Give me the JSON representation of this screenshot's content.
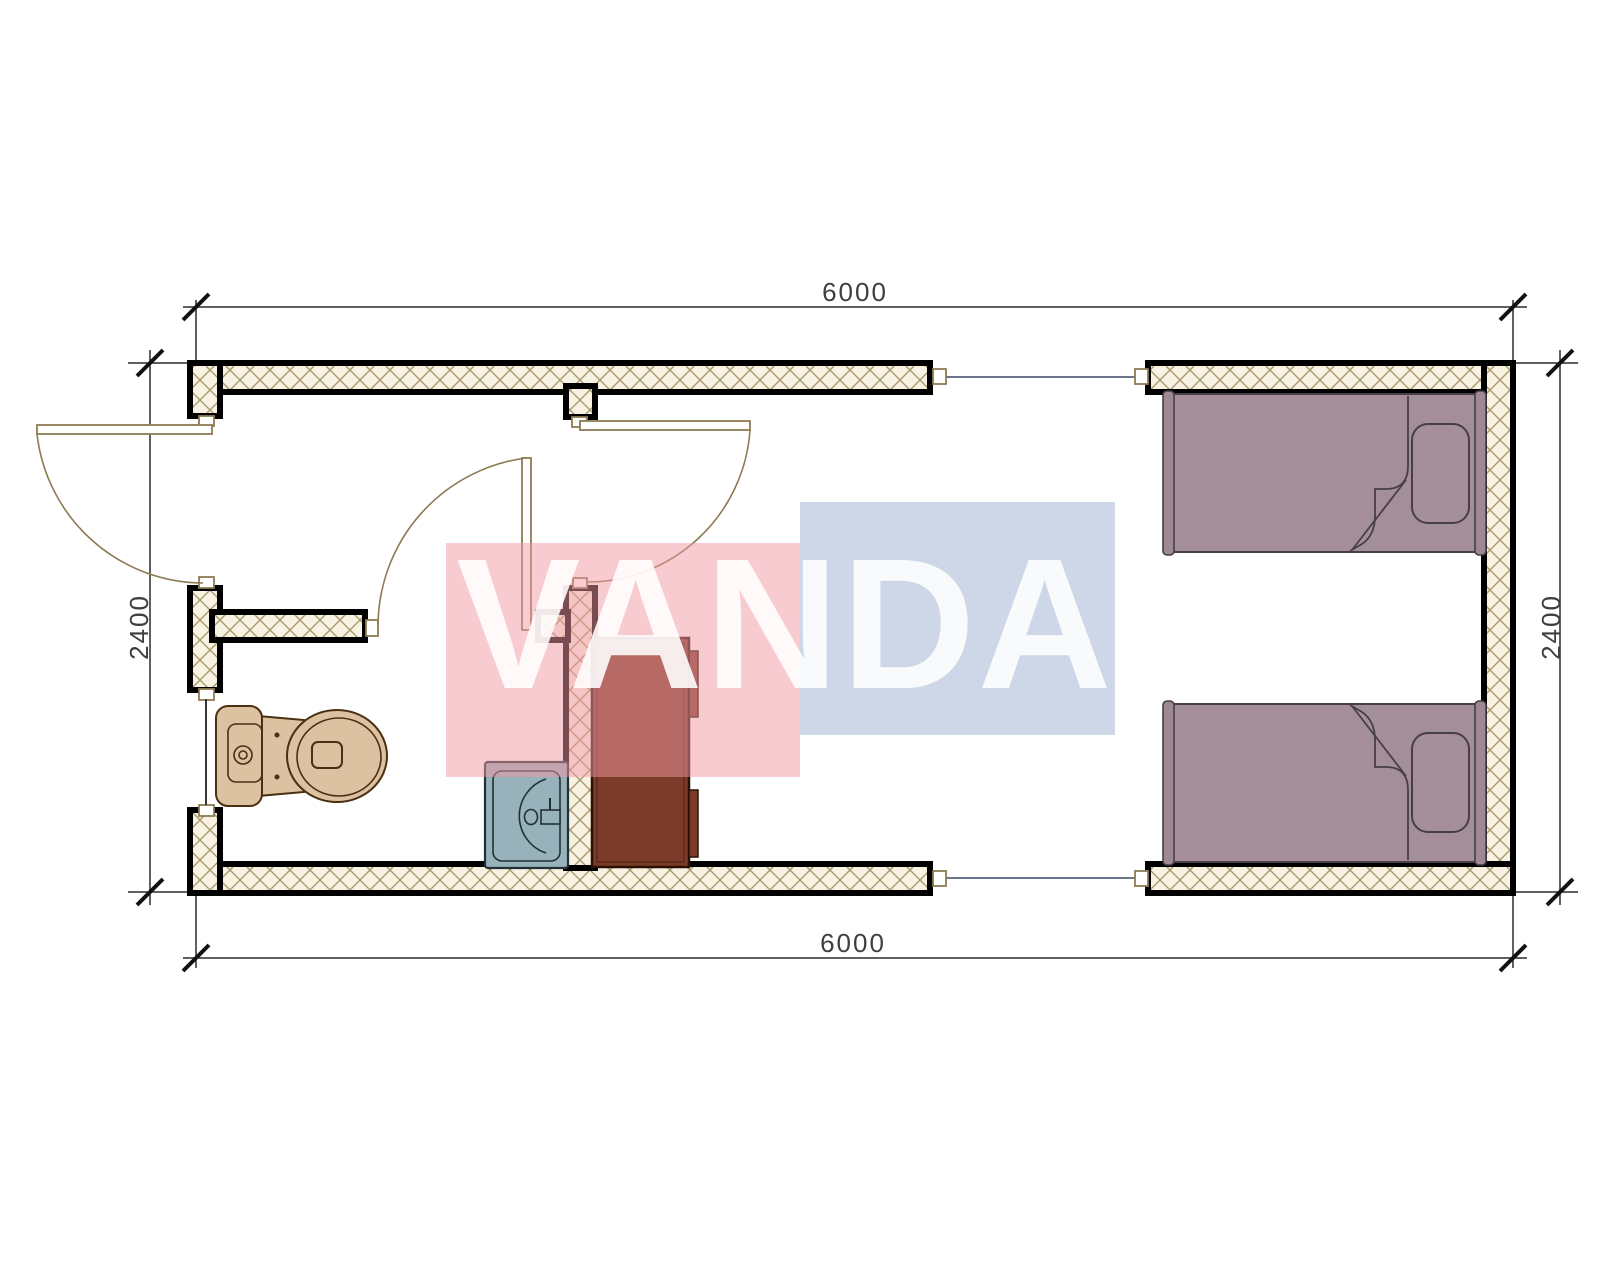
{
  "drawing": {
    "type": "architectural-floor-plan",
    "watermark": {
      "text": "VANDA"
    },
    "dimensions": {
      "top": "6000",
      "bottom": "6000",
      "left": "2400",
      "right": "2400"
    },
    "fixtures": [
      "toilet",
      "sink",
      "wardrobe-cabinet",
      "single-bed-top",
      "single-bed-bottom"
    ],
    "rooms": [
      "bathroom",
      "entry-hall",
      "bedroom"
    ],
    "colors": {
      "wall_fill": "#f8f2e3",
      "wall_hatch_line": "#a89a6e",
      "wall_border": "#000000",
      "door_line": "#8c7b52",
      "module_joint_line": "#3b4668",
      "toilet": "#ddc2a2",
      "toilet_outline": "#4a3010",
      "sink": "#97b2ba",
      "sink_outline": "#223036",
      "cabinet": "#7c3b28",
      "cabinet_outline": "#2a1005",
      "bed": "#a48e99",
      "bed_rail": "#9d8893",
      "bed_outline": "#473f47",
      "watermark_pink": "#f298a3",
      "watermark_blue": "#96accc",
      "dimension_line": "#2b2b2b",
      "dimension_text": "#3f3f3f"
    }
  }
}
